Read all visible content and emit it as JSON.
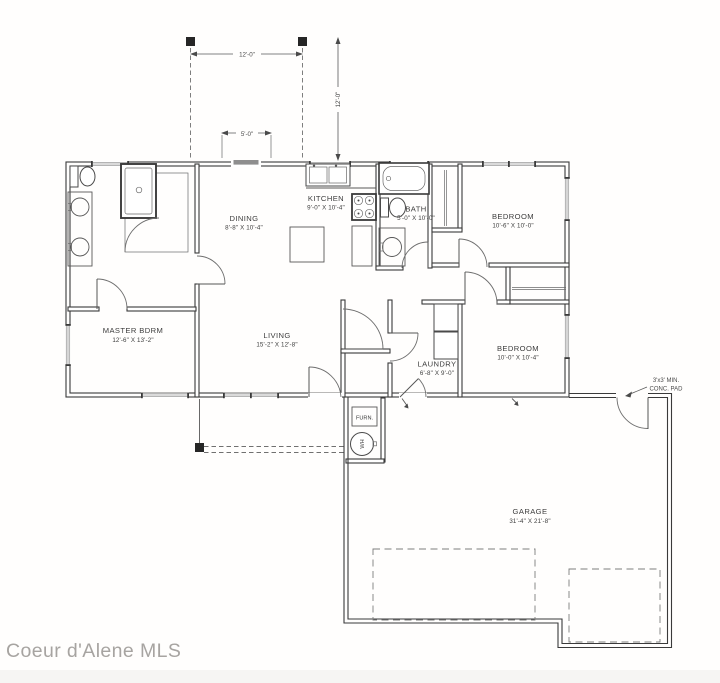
{
  "watermark": "Coeur d'Alene MLS",
  "rooms": {
    "master_bdrm": {
      "name": "MASTER BDRM",
      "dims": "12'-6\" X 13'-2\""
    },
    "living": {
      "name": "LIVING",
      "dims": "15'-2\" X 12'-8\""
    },
    "dining": {
      "name": "DINING",
      "dims": "8'-8\" X 10'-4\""
    },
    "kitchen": {
      "name": "KITCHEN",
      "dims": "9'-0\" X 10'-4\""
    },
    "bath": {
      "name": "BATH",
      "dims": "5'-0\" X 10'-0\""
    },
    "bedroom_top": {
      "name": "BEDROOM",
      "dims": "10'-6\" X 10'-0\""
    },
    "bedroom_right": {
      "name": "BEDROOM",
      "dims": "10'-0\" X 10'-4\""
    },
    "laundry": {
      "name": "LAUNDRY",
      "dims": "6'-8\" X 9'-0\""
    },
    "garage": {
      "name": "GARAGE",
      "dims": "31'-4\" X 21'-8\""
    }
  },
  "equipment": {
    "furnace": "FURN.",
    "water_heater": "WH"
  },
  "dimensions": {
    "porch_width": "12'-0\"",
    "porch_depth": "12'-0\"",
    "entry_width": "5'-0\""
  },
  "notes": {
    "conc_pad_line1": "3'x3' MIN.",
    "conc_pad_line2": "CONC. PAD"
  },
  "colors": {
    "wall_line": "#3a3a3a",
    "dimension_line": "#5a5a5a",
    "watermark": "#a7a4a1",
    "background": "#ffffff"
  }
}
